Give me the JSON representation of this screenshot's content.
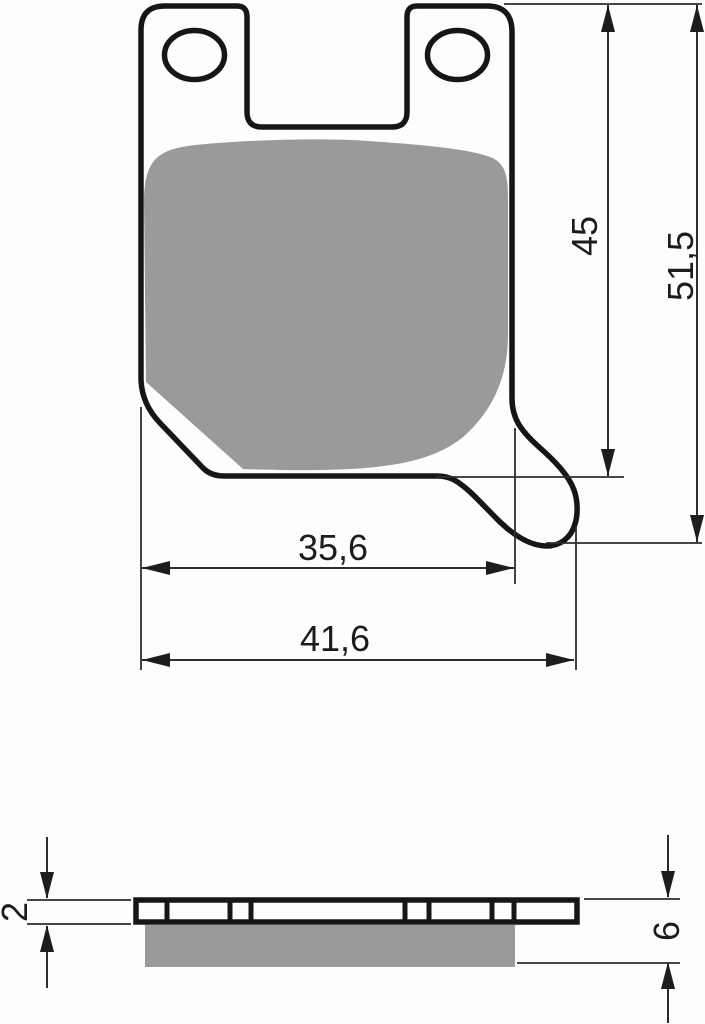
{
  "drawing": {
    "description": "Technical drawing of a brake pad with top view and side profile view",
    "top_view": {
      "dim_pad_height": {
        "name": "friction pad height",
        "value": "45"
      },
      "dim_total_height": {
        "name": "total height",
        "value": "51,5"
      },
      "dim_pad_width": {
        "name": "friction pad width",
        "value": "35,6"
      },
      "dim_total_width": {
        "name": "total width",
        "value": "41,6"
      }
    },
    "side_view": {
      "dim_backplate_thickness": {
        "name": "backing plate thickness",
        "value": "2"
      },
      "dim_total_thickness": {
        "name": "total thickness",
        "value": "6"
      }
    },
    "colors": {
      "outline": "#161616",
      "friction_material": "#9a9a9a",
      "dimension_line": "#2d2d2d",
      "background": "#fdfdfd"
    }
  }
}
